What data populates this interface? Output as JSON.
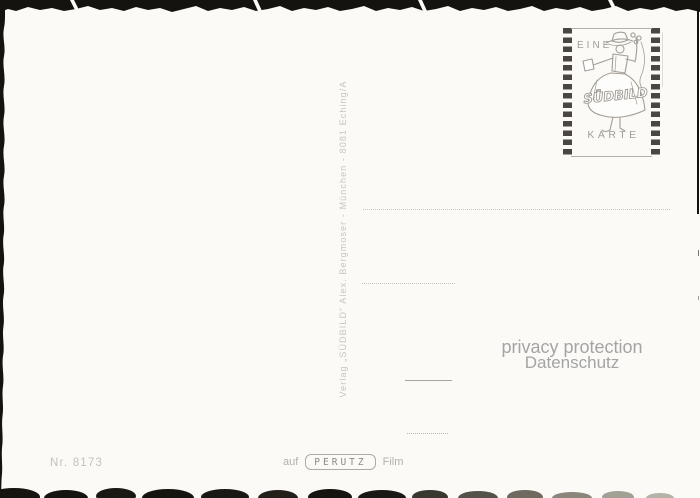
{
  "colors": {
    "paper": "#fbfaf7",
    "stamp_ink": "#a29d96",
    "edge_black": "#15130f",
    "faint_text": "#c6c5c1",
    "privacy_text": "#a4a4a4"
  },
  "stamp": {
    "top_word": "EINE",
    "brand": "SÜDBILD",
    "bottom_word": "KARTE"
  },
  "publisher_line": "Verlag „SÜDBILD“ Alex. Bergmoser - München - 8081 Eching/A",
  "privacy": {
    "line1": "privacy protection",
    "line2": "Datenschutz"
  },
  "footer": {
    "card_number": "Nr. 8173",
    "film_prefix": "auf",
    "film_brand": "PERUTZ",
    "film_suffix": "Film"
  }
}
